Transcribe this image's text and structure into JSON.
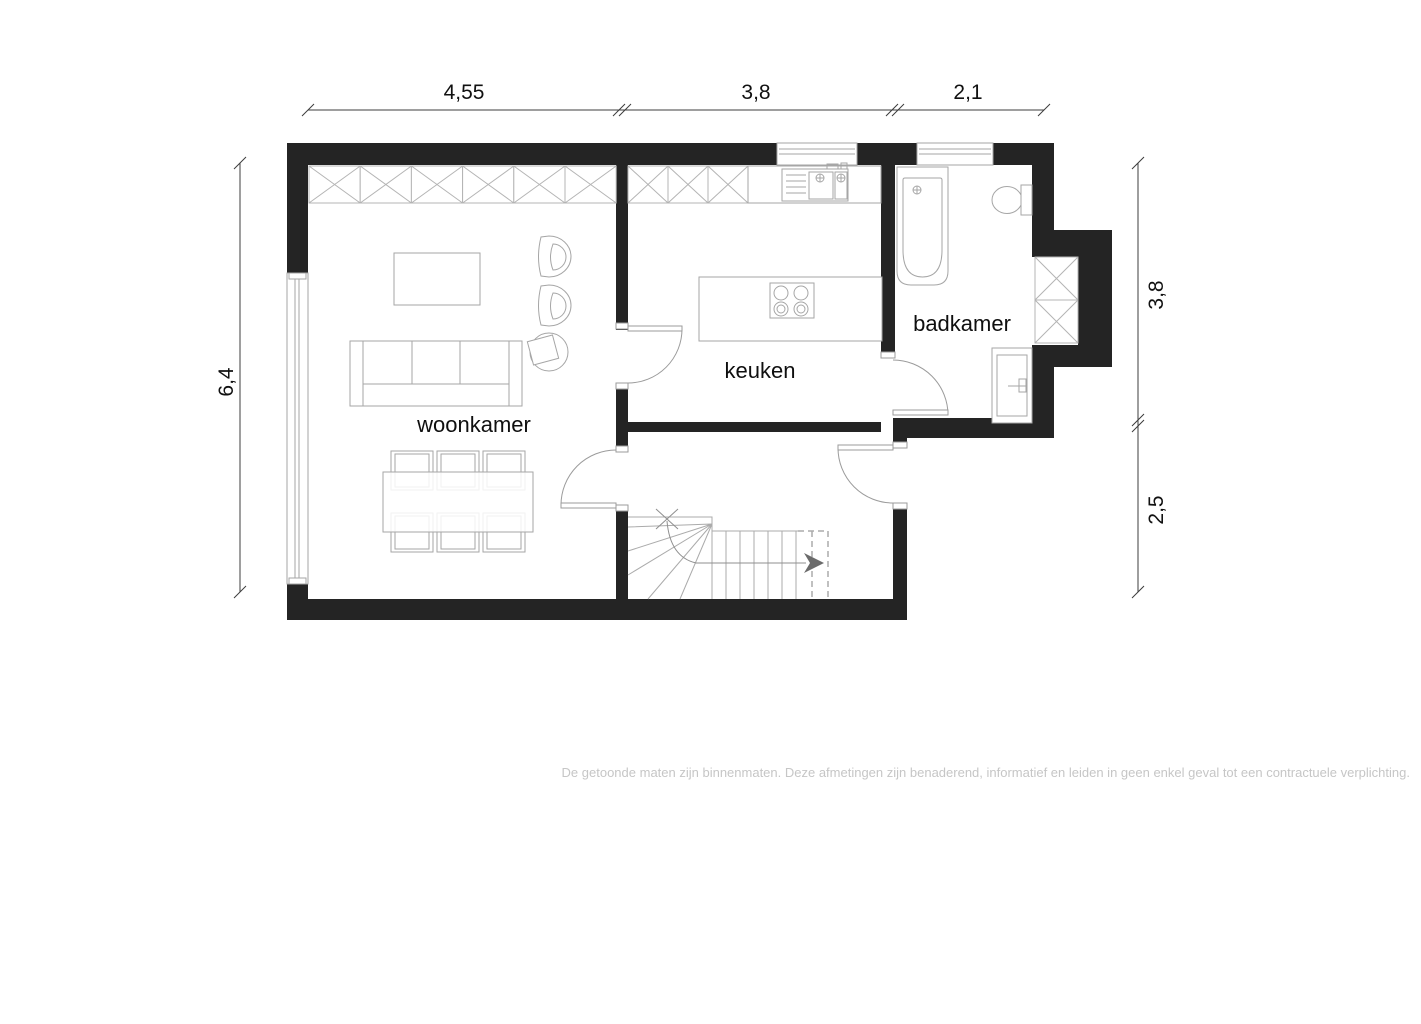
{
  "title": "floor plan",
  "rooms": [
    {
      "name": "woonkamer"
    },
    {
      "name": "keuken"
    },
    {
      "name": "badkamer"
    }
  ],
  "dimensions": {
    "top": [
      {
        "label": "4,55"
      },
      {
        "label": "3,8"
      },
      {
        "label": "2,1"
      }
    ],
    "left": [
      {
        "label": "6,4"
      }
    ],
    "right": [
      {
        "label": "3,8"
      },
      {
        "label": "2,5"
      }
    ]
  },
  "disclaimer": "De getoonde maten zijn binnenmaten. Deze afmetingen zijn benaderend, informatief en leiden in geen enkel geval tot een contractuele verplichting.",
  "colors": {
    "wall": "#242424",
    "furniture_line": "#a6a6a6",
    "hatch_line": "#b4b4b4",
    "dimension_line": "#3c3c3c",
    "label_text": "#0f0f0f",
    "disclaimer_text": "#c6c6c6",
    "stair_arrow": "#6b6b6b"
  },
  "fixtures": {
    "bathroom": [
      "bathtub",
      "toilet",
      "hatched-cabinet",
      "cabinet-door-panel"
    ],
    "kitchen": [
      "sink-counter",
      "island-cooktop"
    ],
    "living_room": [
      "coffee-table",
      "armchairs",
      "sofa",
      "side-chair",
      "dining-table-six-chairs"
    ],
    "hall": [
      "winder-staircase",
      "up-arrow"
    ]
  }
}
